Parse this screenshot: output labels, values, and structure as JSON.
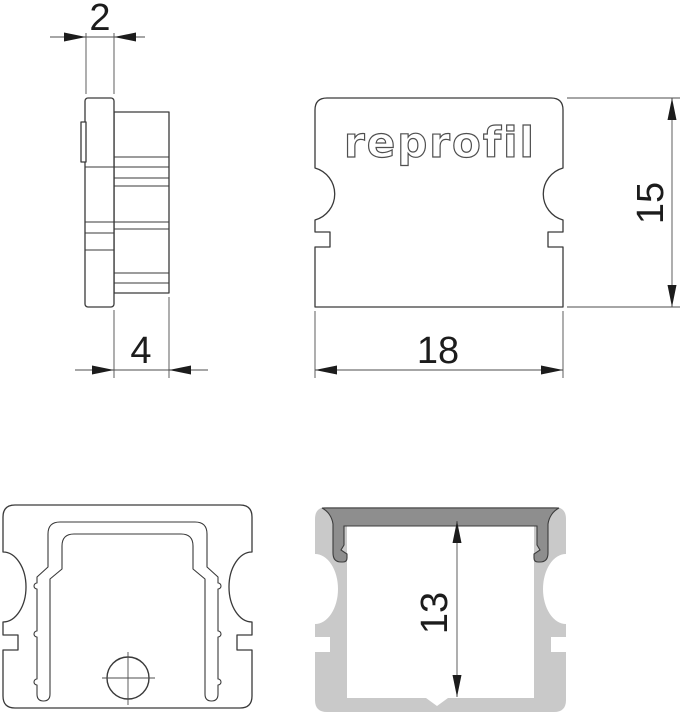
{
  "drawing": {
    "brand_logo": "reprofil",
    "dimensions": {
      "cap_thickness": "2",
      "insert_depth": "4",
      "outer_width": "18",
      "outer_height": "15",
      "inner_height": "13"
    }
  },
  "colors": {
    "outline": "#3a3a3a",
    "dimension_line": "#4d4d4d",
    "wall_gray": "#c9c9c9",
    "flange_dark_gray": "#8e8e8e",
    "background": "#ffffff"
  }
}
